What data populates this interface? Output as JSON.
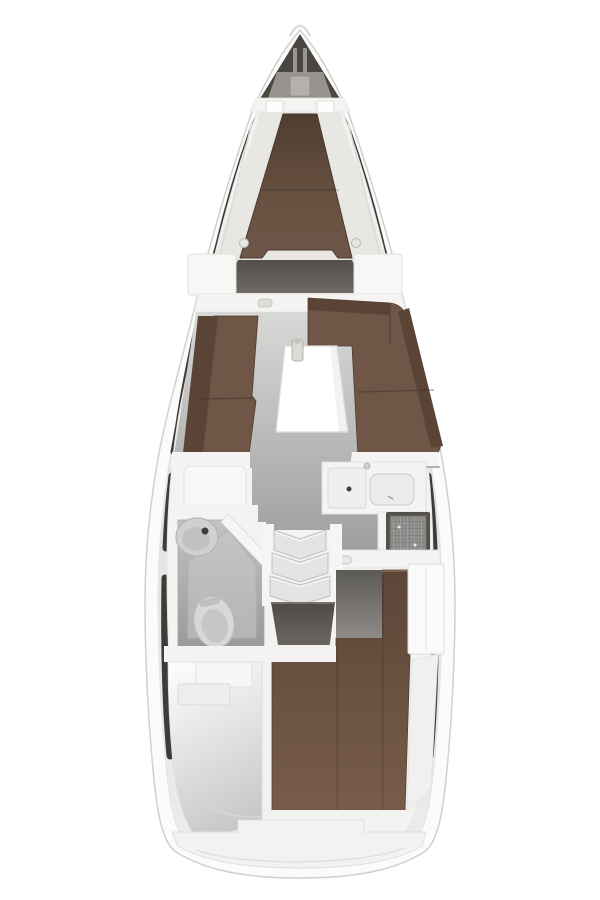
{
  "meta": {
    "diagram": "sailing-yacht-interior-floor-plan",
    "view": "top-down",
    "orientation": "bow-up"
  },
  "colors": {
    "background": "#ffffff",
    "hull": "#fbfbfa",
    "hull_outline": "#d2d0ce",
    "deck_walls": "#f3f3f1",
    "window_stripe": "#3e3b38",
    "bow_locker": "#49453f",
    "bow_locker_lid": "#96928e",
    "bow_roller": "#b3b0ad",
    "bulkhead_wall": "#f5f4f2",
    "shelf": "#e9e7e4",
    "cushion_brown": "#6f5647",
    "cushion_brown_dark": "#5a4436",
    "table_white": "#ffffff",
    "step_gray": "#e4e4e3",
    "counter_white": "#f4f4f3",
    "sink_well": "#ebebea",
    "stove_frame": "#54514d",
    "head_sink": "#d0d0cf",
    "toilet_white": "#d8d8d7",
    "wardrobe_white": "#fafaf9",
    "stern_platform": "#f2f2f0",
    "storage_wall": "#f2f1ef"
  },
  "areas": [
    {
      "id": "anchor-locker",
      "position": "bow",
      "features": [
        "bow-roller",
        "pulpit"
      ]
    },
    {
      "id": "forward-cabin",
      "position": "fore",
      "features": [
        "v-berth-double-bed",
        "side-shelves",
        "reading-lights"
      ]
    },
    {
      "id": "saloon",
      "position": "midship",
      "features": [
        "port-settee",
        "starboard-l-settee",
        "saloon-table",
        "bottle-on-table"
      ]
    },
    {
      "id": "galley",
      "position": "starboard-aft",
      "features": [
        "worktop",
        "twin-sink",
        "stove"
      ]
    },
    {
      "id": "head",
      "position": "port-aft",
      "features": [
        "washbasin",
        "toilet",
        "shower-floor",
        "angled-door"
      ]
    },
    {
      "id": "companionway",
      "position": "center",
      "features": [
        "three-steps",
        "landing"
      ]
    },
    {
      "id": "aft-cabin",
      "position": "stern-starboard",
      "features": [
        "double-berth",
        "wardrobe",
        "entry-floor"
      ]
    },
    {
      "id": "stowage-locker",
      "position": "stern-port",
      "features": [
        "step-box"
      ]
    },
    {
      "id": "stern-platform",
      "position": "stern",
      "features": [
        "transom-step"
      ]
    }
  ]
}
